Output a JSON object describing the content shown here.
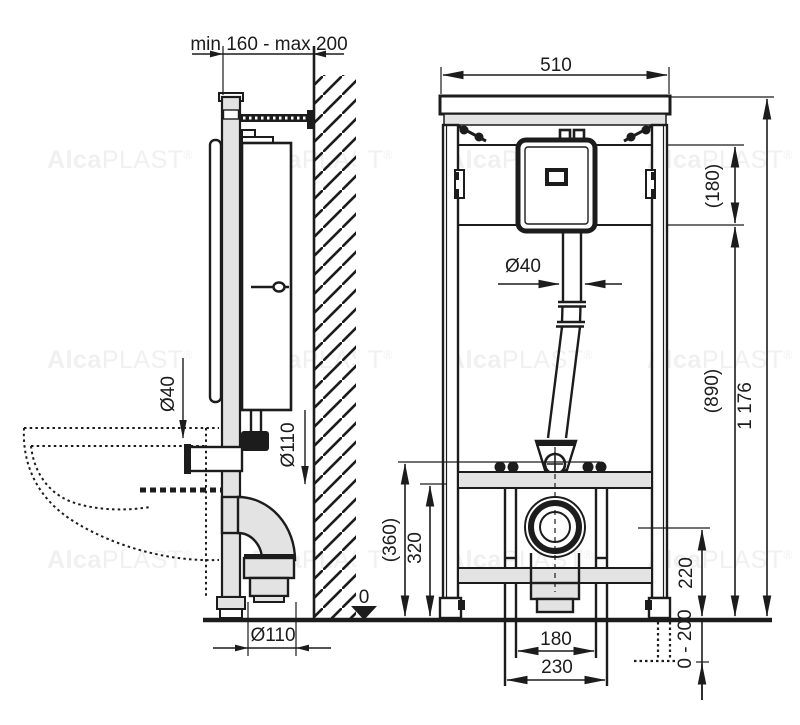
{
  "drawing": {
    "type": "technical installation drawing, WC mounting frame, two orthographic views",
    "colors": {
      "line": "#1c1c1c",
      "fill_light": "#e3e3e3",
      "watermark": "#f0f0f0",
      "background": "#ffffff"
    },
    "labels": {
      "depth_range": "min 160 - max 200",
      "frame_width": "510",
      "cistern_zone_height": "(180)",
      "flush_bend_height": "(890)",
      "total_height": "1 176",
      "dia40": "Ø40",
      "dia110": "Ø110",
      "bowl_height": "(360)",
      "support_height": "320",
      "waste_outlet_height": "220",
      "leg_adjustment": "0 - 200",
      "stud_spacing": "180",
      "fixing_spacing": "230",
      "floor_datum": "0"
    },
    "watermark": {
      "prefix": "Alca",
      "suffix": "PLAST",
      "reg": "®"
    }
  }
}
